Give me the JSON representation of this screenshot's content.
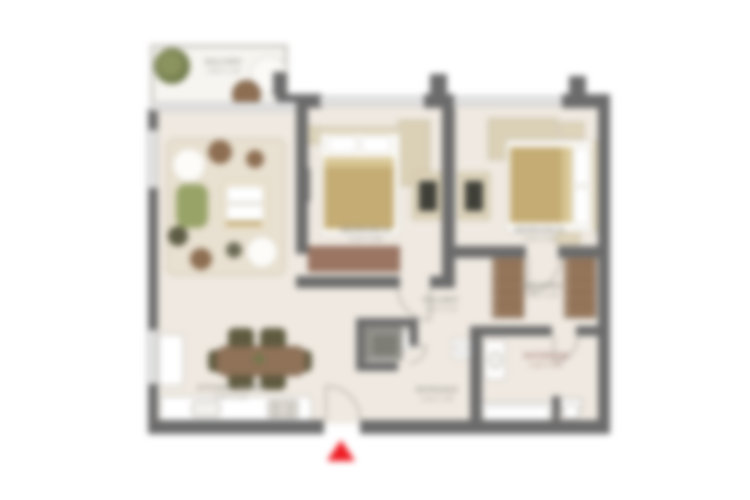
{
  "title": "apartment-floor-plan",
  "palette": {
    "wall": "#6b6b6b",
    "glass": "#c9c9c9",
    "floor": "#efe9e1",
    "balcony_floor": "#f7f5f0",
    "rug": "#e8e0d0",
    "wood": "#8f7258",
    "wood_dark": "#8d6e52",
    "wardrobe": "#96765a",
    "bench": "#9b7562",
    "closet": "#ded4ba",
    "blanket": "#c4ac74",
    "blanket_fold": "#d8c795",
    "chair_olive": "#5f5b40",
    "plant_green": "#6f7a4a",
    "plant_dark": "#5d5c44",
    "sofa_green": "#98a368",
    "sofa_cream": "#efe6d2",
    "fixture_dark": "#7d7d76",
    "label": "#8f8d86",
    "label_red": "#9a6f6a",
    "accent_red": "#ee1b23"
  },
  "rooms": {
    "balcony": {
      "name": "BALCONY",
      "dims": "3.60 X 1.40"
    },
    "living_dining": {
      "name": "KITCHEN / DINING",
      "dims": "5.20 X 4.10"
    },
    "bedroom_1": {
      "name": "BEDROOM 01",
      "dims": "3.20 X 3.60"
    },
    "bedroom_2": {
      "name": "BEDROOM 02",
      "dims": "3.40 X 3.60"
    },
    "hallway": {
      "name": "HALLWAY",
      "dims": "1.50 X 3.10"
    },
    "entrance": {
      "name": "ENTRANCE",
      "dims": "1.40 X 1.60"
    },
    "dressing": {
      "name": "DRESSING",
      "dims": "1.80 X 1.40"
    },
    "master_bathroom": {
      "name": "BATHROOM",
      "dims": "2.40 X 2.00"
    }
  },
  "entrance_marker": {
    "shape": "triangle-up",
    "color": "#ee1b23"
  }
}
